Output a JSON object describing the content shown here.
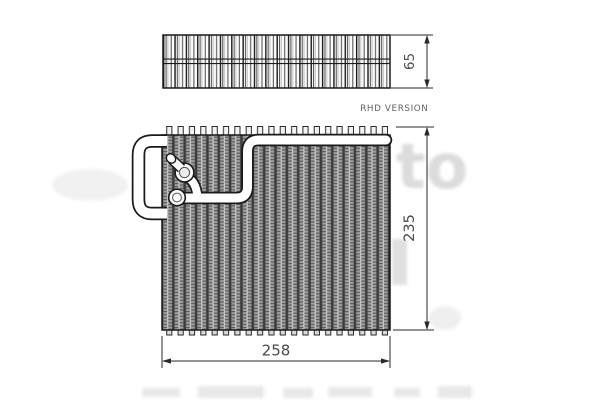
{
  "diagram": {
    "labels": {
      "top_depth": "65",
      "front_height": "235",
      "front_width": "258",
      "version_note": "RHD VERSION"
    },
    "watermark": {
      "text": "to"
    },
    "colors": {
      "line": "#1a1a1a",
      "dim_line": "#2a2a2a",
      "dim_text": "#4a4a4a",
      "note_text": "#636363",
      "fin_mid": "#9e9e9e",
      "background": "#ffffff",
      "watermark": "#e2e2e2"
    }
  }
}
